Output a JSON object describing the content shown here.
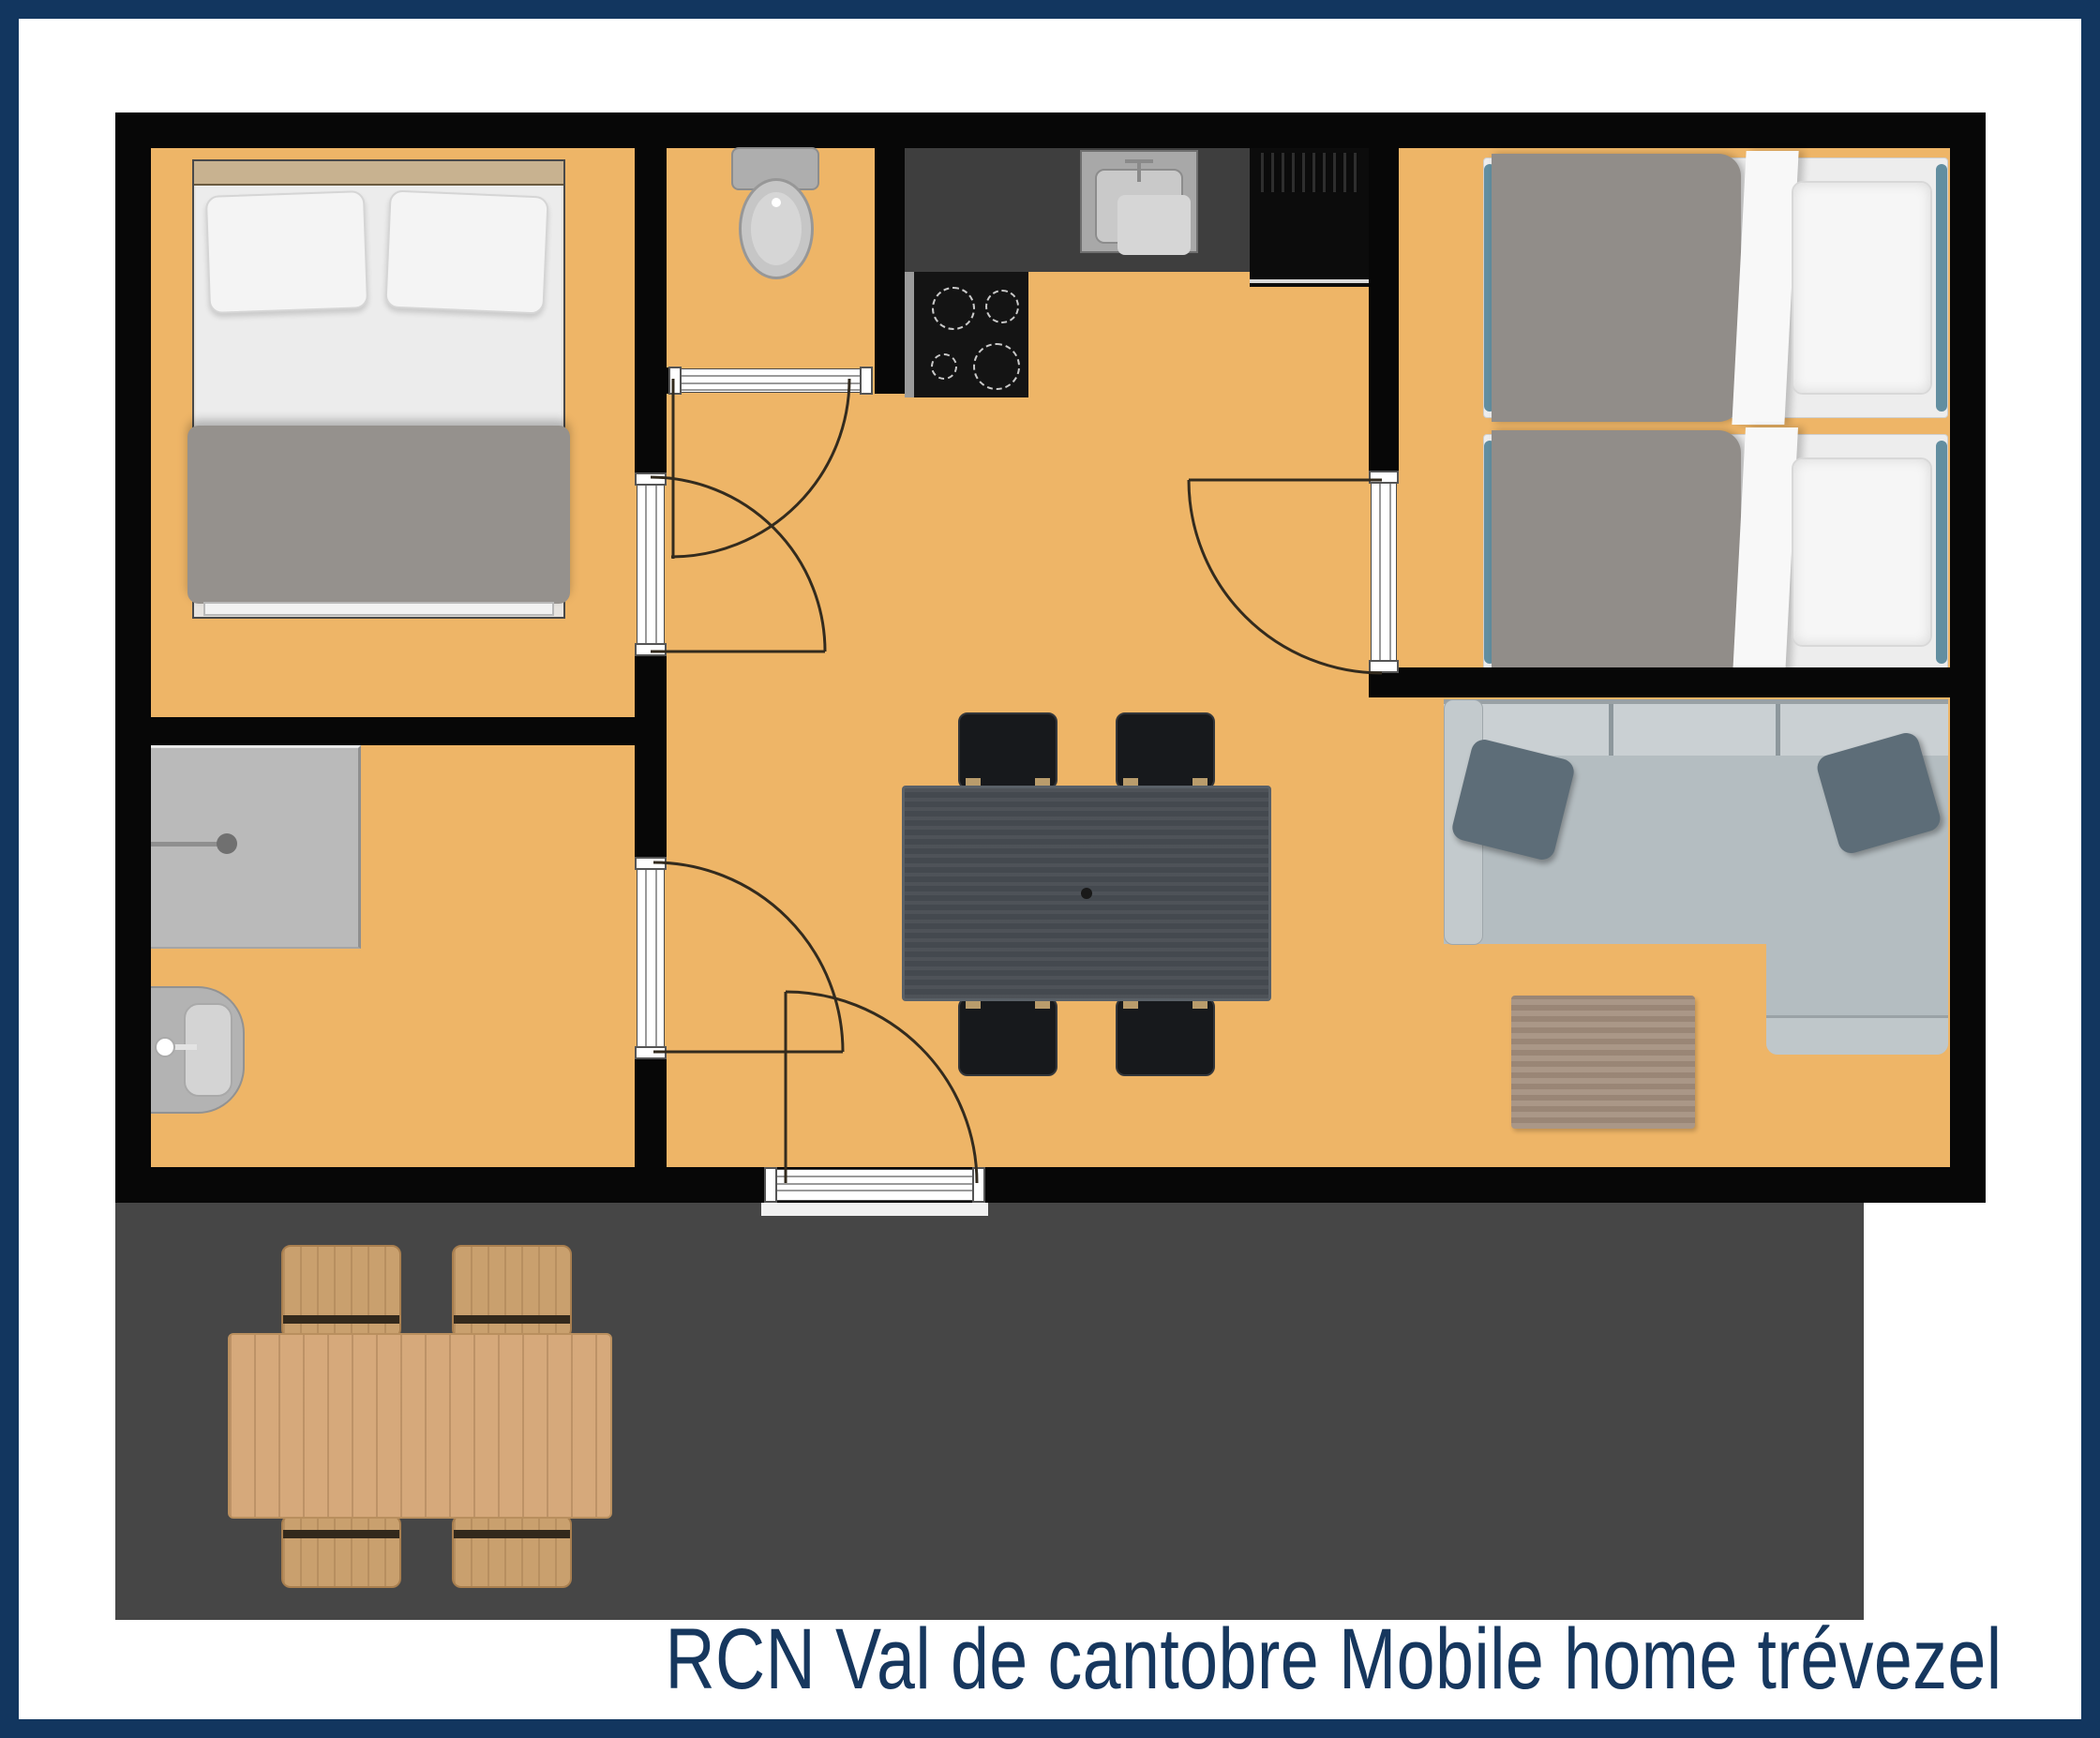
{
  "caption": {
    "text": "RCN Val de cantobre Mobile home trévezel"
  },
  "colors": {
    "frame_border": "#12365f",
    "caption_text": "#16375e",
    "wall": "#070707",
    "floor": "#eeb567",
    "terrace": "#464646",
    "kitchen_counter": "#3e3e3e",
    "appliance_black": "#0c0c0c",
    "sanitary_gray": "#bababa",
    "sofa_body": "#b4bdc1",
    "sofa_cushion": "#5d6d78",
    "rug": "#a38e7d",
    "dining_table": "#484d53",
    "dining_chair": "#17191c",
    "outdoor_wood": "#d6a97b",
    "bed_duvet": "#95918d",
    "bed_linen": "#f0f0f0",
    "twin_bed_rail": "#628ea0"
  },
  "floorplan": {
    "rooms": [
      {
        "id": "bedroom-double",
        "label": "double bedroom",
        "furniture": [
          "double-bed"
        ]
      },
      {
        "id": "bathroom",
        "label": "bathroom",
        "furniture": [
          "shower",
          "washbasin"
        ]
      },
      {
        "id": "wc",
        "label": "toilet room",
        "furniture": [
          "toilet"
        ]
      },
      {
        "id": "kitchen",
        "label": "kitchen",
        "furniture": [
          "counter",
          "kitchen-sink",
          "cooktop-4-burners",
          "tall-appliance"
        ]
      },
      {
        "id": "bedroom-twin",
        "label": "twin bedroom",
        "furniture": [
          "single-bed",
          "single-bed"
        ]
      },
      {
        "id": "living-dining",
        "label": "living / dining room",
        "furniture": [
          "dining-table",
          "dining-chair",
          "dining-chair",
          "dining-chair",
          "dining-chair",
          "corner-sofa",
          "scatter-cushion",
          "scatter-cushion",
          "rug"
        ]
      },
      {
        "id": "terrace",
        "label": "terrace deck",
        "furniture": [
          "garden-table",
          "garden-chair",
          "garden-chair",
          "garden-chair",
          "garden-chair"
        ]
      }
    ],
    "doors": [
      "double-bedroom-door",
      "wc-sliding-door",
      "bathroom-door",
      "twin-bedroom-door",
      "entrance-door"
    ]
  }
}
